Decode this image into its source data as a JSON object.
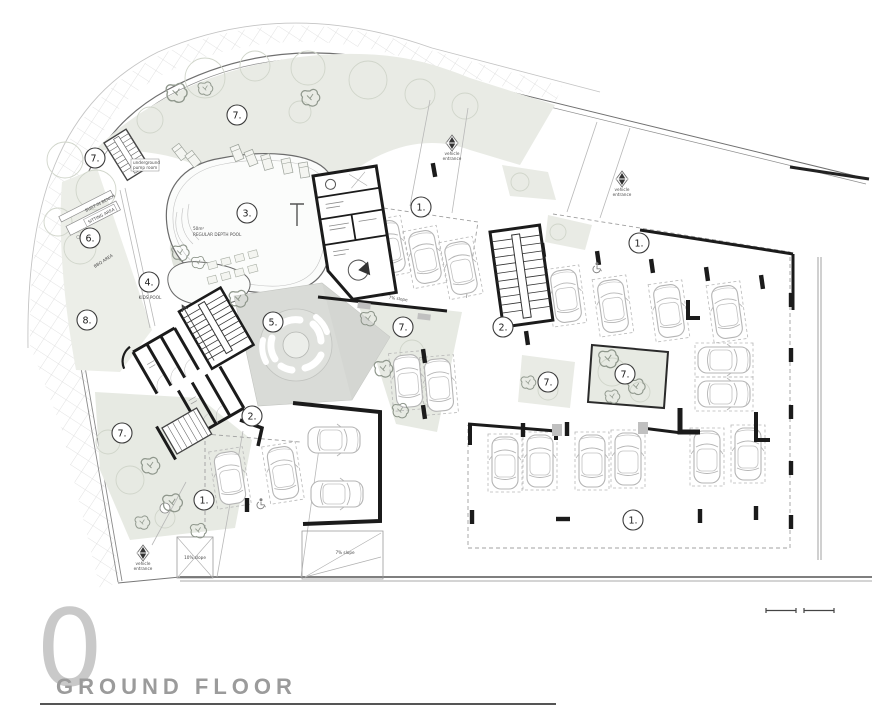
{
  "title_block": {
    "floor_number": "0",
    "title": "GROUND FLOOR"
  },
  "labels": {
    "pool_area_line1": "50m²",
    "pool_area_line2": "REGULAR DEPTH POOL",
    "kids_pool": "KIDS POOL",
    "bbq_area": "BBQ AREA",
    "sitting_area": "SITTING AREA",
    "built_in_bench": "BUILT-IN BENCH",
    "pump_room_line1": "underground",
    "pump_room_line2": "pump room",
    "vehicle_entrance_line1": "vehicle",
    "vehicle_entrance_line2": "entrance",
    "slope_driveway": "7% slope",
    "slope_ramp_small": "10% slope",
    "slope_ramp_large": "7% slope"
  },
  "markers": [
    {
      "label": "7."
    },
    {
      "label": "7."
    },
    {
      "label": "6."
    },
    {
      "label": "8."
    },
    {
      "label": "3."
    },
    {
      "label": "4."
    },
    {
      "label": "5."
    },
    {
      "label": "7."
    },
    {
      "label": "1."
    },
    {
      "label": "2."
    },
    {
      "label": "1."
    },
    {
      "label": "2."
    },
    {
      "label": "7."
    },
    {
      "label": "7."
    },
    {
      "label": "7."
    },
    {
      "label": "1."
    },
    {
      "label": "1."
    }
  ],
  "colors": {
    "wall": "#1b1b1b",
    "green_area": "#e9ebe5",
    "plaza": "#d9dbd7",
    "car_outline": "#b5b5b5",
    "title_gray": "#9b9b9b",
    "floor_number_gray": "#c9c9c9"
  }
}
